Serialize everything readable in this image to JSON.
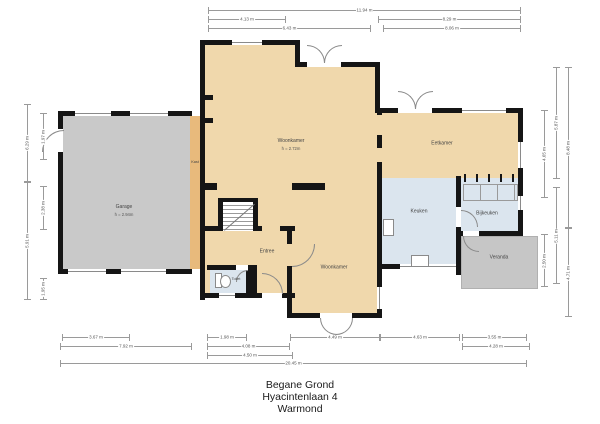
{
  "plan": {
    "rooms": {
      "woonkamer_top": {
        "name": "Woonkamer",
        "height": "h = 2.72m"
      },
      "garage": {
        "name": "Garage",
        "height": "h = 2.94m"
      },
      "kast": {
        "name": "Kast"
      },
      "eetkamer": {
        "name": "Eetkamer"
      },
      "keuken": {
        "name": "Keuken"
      },
      "bijkeuken": {
        "name": "Bijkeuken"
      },
      "entree": {
        "name": "Entree"
      },
      "toilet": {
        "name": "Toilet"
      },
      "woonkamer_bottom": {
        "name": "Woonkamer"
      },
      "veranda": {
        "name": "Veranda"
      }
    },
    "dimensions": {
      "top": [
        "11.94 m",
        "4.13 m",
        "8.29 m",
        "6.43 m",
        "8.06 m"
      ],
      "bottom": [
        "3.67 m",
        "1.98 m",
        "4.49 m",
        "4.63 m",
        "3.55 m",
        "7.92 m",
        "4.08 m",
        "4.28 m",
        "4.50 m",
        "20.45 m"
      ],
      "left": [
        "6.29 m",
        "5.91 m",
        "1.97 m",
        "2.38 m",
        "1.95 m"
      ],
      "right": [
        "5.87 m",
        "8.48 m",
        "4.65 m",
        "5.11 m",
        "2.50 m",
        "4.71 m"
      ]
    },
    "footer": {
      "floor": "Begane Grond",
      "street": "Hyacintenlaan 4",
      "city": "Warmond"
    },
    "colors": {
      "floor_tan": "#f0d8ac",
      "floor_blue": "#dbe5ee",
      "garage_gray": "#c9c9c9",
      "veranda_gray": "#c6c6c6",
      "kast_orange": "#e8ba7c",
      "wall_black": "#151515"
    }
  }
}
